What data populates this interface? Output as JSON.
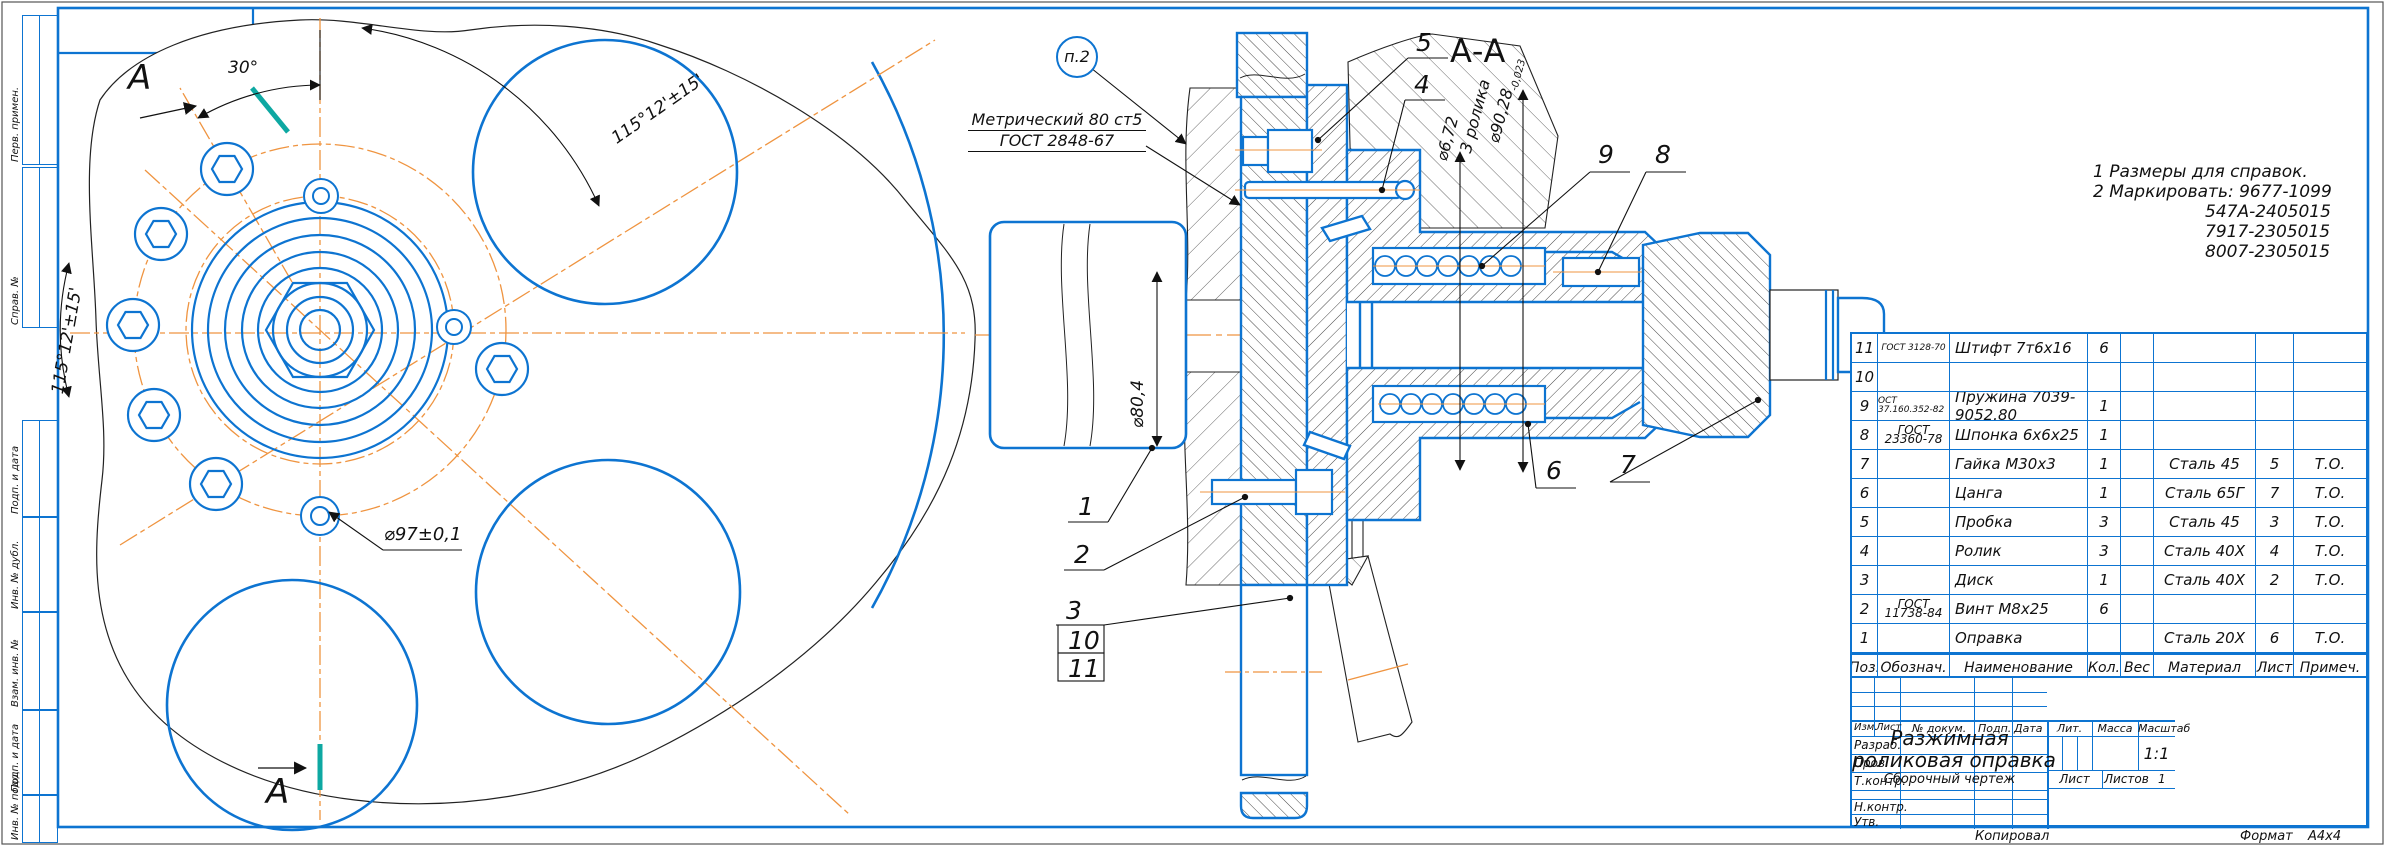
{
  "colors": {
    "line_blue": "#0d74d1",
    "centerline_orange": "#ef9440",
    "section_teal": "#0ea8a2",
    "line_black": "#111111"
  },
  "frame_labels": {
    "perv": "Перв. примен.",
    "sprav": "Справ. №",
    "podp1": "Подп. и дата",
    "inv_dubl": "Инв. № дубл.",
    "vzam": "Взам. инв. №",
    "podp2": "Подп. и дата",
    "inv_podl": "Инв. № подл."
  },
  "notes": {
    "line1": "1 Размеры для справок.",
    "line2": "2 Маркировать: 9677-1099",
    "line3": "547А-2405015",
    "line4": "7917-2305015",
    "line5": "8007-2305015"
  },
  "thread_callout": {
    "line1": "Метрический 80 ст5",
    "line2": "ГОСТ 2848-67"
  },
  "balloon": {
    "label": "п.2"
  },
  "section": {
    "title": "А-А"
  },
  "view_labels": {
    "section_arrow_top": "A",
    "section_arrow_bottom": "A"
  },
  "dims": {
    "angle30": "30°",
    "angle115_top": "115°12'±15'",
    "angle115_left": "115°12'±15'",
    "d97": "⌀97±0,1",
    "d80": "⌀80,4",
    "d672": "⌀6,72",
    "rollers": "3 ролика",
    "d9028": "⌀90,28",
    "d9028_tol": "-0,023"
  },
  "callouts": {
    "c1": "1",
    "c2": "2",
    "c3": "3",
    "c4": "4",
    "c5": "5",
    "c6": "6",
    "c7": "7",
    "c8": "8",
    "c9": "9",
    "c10": "10",
    "c11": "11"
  },
  "parts_table": {
    "headers": {
      "pos": "Поз.",
      "doc": "Обознач.",
      "name": "Наименование",
      "qty": "Кол.",
      "wt": "Вес",
      "mat": "Материал",
      "sheet": "Лист",
      "note": "Примеч."
    },
    "rows": [
      {
        "pos": "11",
        "doc": "ГОСТ 3128-70",
        "doc2": "",
        "name": "Штифт 7т6х16",
        "qty": "6",
        "wt": "",
        "mat": "",
        "sheet": "",
        "note": ""
      },
      {
        "pos": "10",
        "doc": "",
        "doc2": "",
        "name": "",
        "qty": "",
        "wt": "",
        "mat": "",
        "sheet": "",
        "note": ""
      },
      {
        "pos": "9",
        "doc": "ОСТ 37.160.352-82",
        "doc2": "",
        "name": "Пружина 7039-9052.80",
        "qty": "1",
        "wt": "",
        "mat": "",
        "sheet": "",
        "note": ""
      },
      {
        "pos": "8",
        "doc": "ГОСТ",
        "doc2": "23360-78",
        "name": "Шпонка 6х6х25",
        "qty": "1",
        "wt": "",
        "mat": "",
        "sheet": "",
        "note": ""
      },
      {
        "pos": "7",
        "doc": "",
        "doc2": "",
        "name": "Гайка М30х3",
        "qty": "1",
        "wt": "",
        "mat": "Сталь 45",
        "sheet": "5",
        "note": "Т.О."
      },
      {
        "pos": "6",
        "doc": "",
        "doc2": "",
        "name": "Цанга",
        "qty": "1",
        "wt": "",
        "mat": "Сталь 65Г",
        "sheet": "7",
        "note": "Т.О."
      },
      {
        "pos": "5",
        "doc": "",
        "doc2": "",
        "name": "Пробка",
        "qty": "3",
        "wt": "",
        "mat": "Сталь 45",
        "sheet": "3",
        "note": "Т.О."
      },
      {
        "pos": "4",
        "doc": "",
        "doc2": "",
        "name": "Ролик",
        "qty": "3",
        "wt": "",
        "mat": "Сталь 40Х",
        "sheet": "4",
        "note": "Т.О."
      },
      {
        "pos": "3",
        "doc": "",
        "doc2": "",
        "name": "Диск",
        "qty": "1",
        "wt": "",
        "mat": "Сталь 40Х",
        "sheet": "2",
        "note": "Т.О."
      },
      {
        "pos": "2",
        "doc": "ГОСТ",
        "doc2": "11738-84",
        "name": "Винт М8х25",
        "qty": "6",
        "wt": "",
        "mat": "",
        "sheet": "",
        "note": ""
      },
      {
        "pos": "1",
        "doc": "",
        "doc2": "",
        "name": "Оправка",
        "qty": "",
        "wt": "",
        "mat": "Сталь 20Х",
        "sheet": "6",
        "note": "Т.О."
      }
    ]
  },
  "title_block": {
    "col_izm": "Изм.",
    "col_list": "Лист",
    "col_doc": "№ докум.",
    "col_podp": "Подп.",
    "col_data": "Дата",
    "role_razrab": "Разраб.",
    "role_prov": "Пров.",
    "role_tkontr": "Т.контр.",
    "role_nkontr": "Н.контр.",
    "role_utv": "Утв.",
    "product_line1": "Разжимная",
    "product_line2": "роликовая оправка",
    "doc_type": "Сборочный чертеж",
    "lit": "Лит.",
    "mass": "Масса",
    "scale": "Масштаб",
    "scale_value": "1:1",
    "sheet": "Лист",
    "sheets": "Листов",
    "sheets_value": "1"
  },
  "footer": {
    "copied": "Копировал",
    "format": "Формат",
    "format_value": "А4х4"
  }
}
